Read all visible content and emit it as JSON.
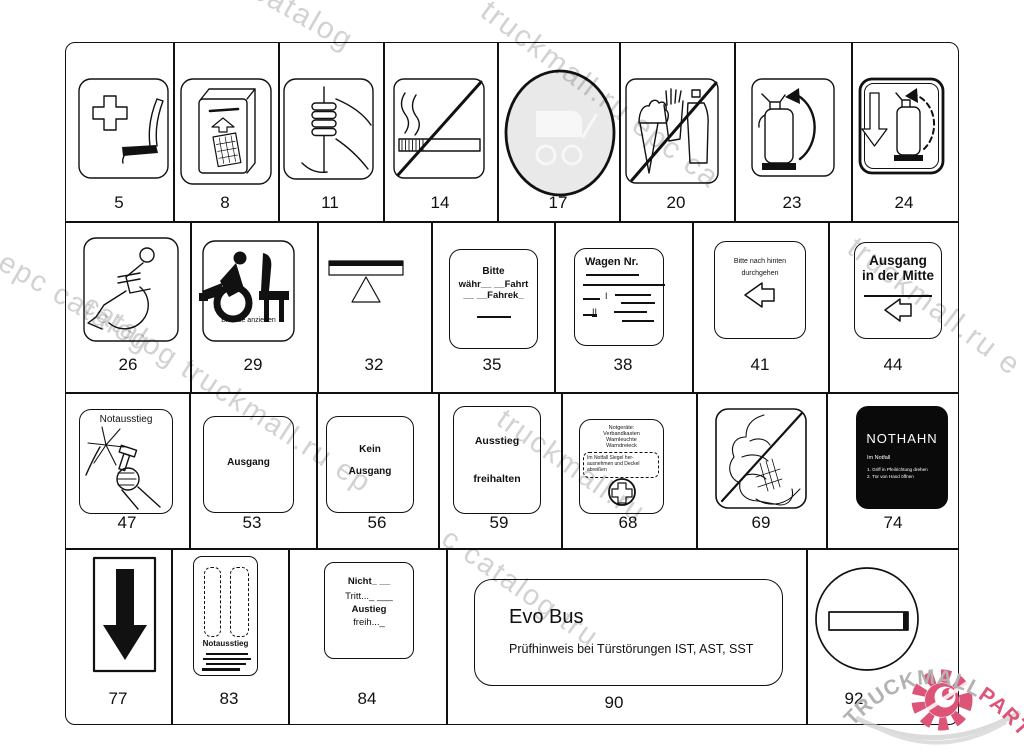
{
  "colors": {
    "logo_pink": "#dc5478",
    "logo_gray": "#b3b3b3",
    "watermark_gray": "#d2d2d2",
    "pictogram_gray_fill": "#e9e9e9",
    "sign_black_bg": "#0a0a0a"
  },
  "watermarks": {
    "w1": "c catalog",
    "w2": "truckmall.ru epc ca",
    "w3": "truckmall.ru e",
    "w4": "l epc catalog",
    "w5": "catalog truckmall.ru ep",
    "w6": "truckmall.ru",
    "w7": "c catalog tru"
  },
  "logo": {
    "gray": "TRUCKMALL",
    "pink": "PARTS"
  },
  "cells": {
    "c5": {
      "num": "5"
    },
    "c8": {
      "num": "8"
    },
    "c11": {
      "num": "11"
    },
    "c14": {
      "num": "14"
    },
    "c17": {
      "num": "17"
    },
    "c20": {
      "num": "20"
    },
    "c23": {
      "num": "23"
    },
    "c24": {
      "num": "24"
    },
    "c26": {
      "num": "26"
    },
    "c29": {
      "num": "29",
      "label": "Bremse anziehen"
    },
    "c32": {
      "num": "32"
    },
    "c35": {
      "num": "35",
      "lines": [
        "Bitte",
        "währ__ __Fahrt",
        "__ __Fahrek_"
      ]
    },
    "c38": {
      "num": "38",
      "title": "Wagen Nr.",
      "marker1": "I",
      "marker2": "II"
    },
    "c41": {
      "num": "41",
      "lines": [
        "Bitte nach hinten",
        "durchgehen"
      ]
    },
    "c44": {
      "num": "44",
      "lines": [
        "Ausgang",
        "in der Mitte"
      ]
    },
    "c47": {
      "num": "47",
      "label": "Notausstieg"
    },
    "c53": {
      "num": "53",
      "label": "Ausgang"
    },
    "c56": {
      "num": "56",
      "lines": [
        "Kein",
        "Ausgang"
      ]
    },
    "c59": {
      "num": "59",
      "lines": [
        "Ausstieg",
        "freihalten"
      ]
    },
    "c68": {
      "num": "68",
      "lines": [
        "Notgeräte:",
        "Verbandkasten",
        "Warnleuchte",
        "Warndreieck"
      ],
      "note_lines": [
        "Im Notfall Siegel her-",
        "ausnehmen und Deckel",
        "abreißen"
      ]
    },
    "c69": {
      "num": "69"
    },
    "c74": {
      "num": "74",
      "title": "NOTHAHN",
      "subtitle": "Im Notfall",
      "lines": [
        "1. Griff in Pfeilrichtung drehen",
        "2. Tür von Hand öffnen"
      ]
    },
    "c77": {
      "num": "77"
    },
    "c83": {
      "num": "83",
      "label": "Notausstieg"
    },
    "c84": {
      "num": "84",
      "lines": [
        "Nicht_ __",
        "Tritt..._ ___",
        "Austieg",
        "freih..._"
      ]
    },
    "c90": {
      "num": "90",
      "title": "Evo Bus",
      "subtitle": "Prüfhinweis bei Türstörungen IST, AST, SST"
    },
    "c92": {
      "num": "92"
    }
  }
}
